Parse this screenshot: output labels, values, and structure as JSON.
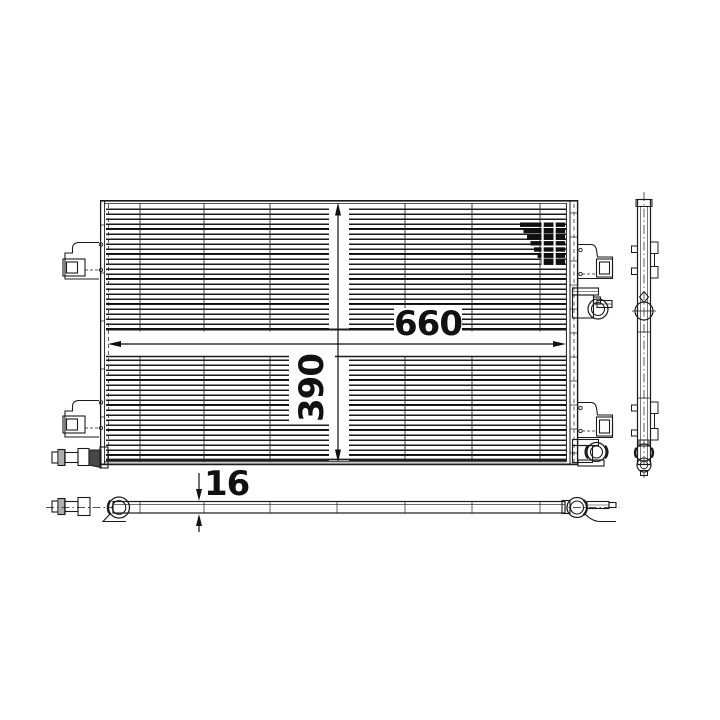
{
  "drawing": {
    "type": "technical-drawing",
    "subject": "vehicle AC condenser, three orthographic views",
    "dimensions": {
      "width_mm": "660",
      "height_mm": "390",
      "depth_mm": "16"
    },
    "colors": {
      "line": "#1b1b1b",
      "background": "#ffffff"
    }
  }
}
